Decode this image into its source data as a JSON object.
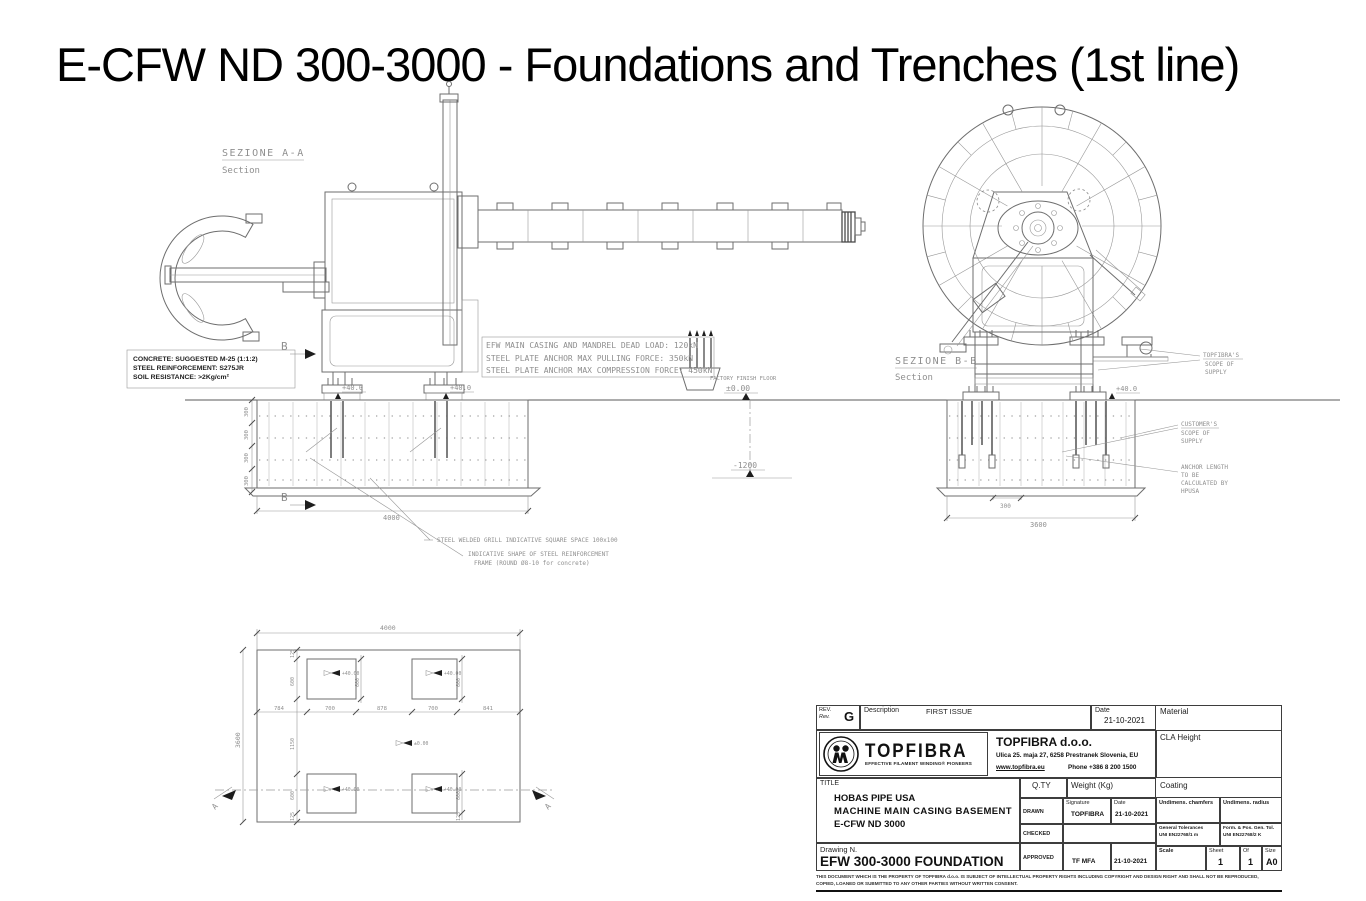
{
  "page": {
    "title": "E-CFW ND 300-3000 - Foundations and Trenches (1st line)"
  },
  "colors": {
    "background": "#ffffff",
    "cad_line": "#6e6e6e",
    "cad_text": "#8f8f8f",
    "ink": "#111111"
  },
  "section_a": {
    "label": "SEZIONE  A-A",
    "sublabel": "Section"
  },
  "section_b": {
    "label": "SEZIONE  B-B",
    "sublabel": "Section"
  },
  "section_markers": {
    "a": "A",
    "b": "B"
  },
  "concrete_note": {
    "line1": "CONCRETE: SUGGESTED M-25 (1:1:2)",
    "line2": "STEEL REINFORCEMENT: S275JR",
    "line3": "SOIL RESISTANCE: >2Kg/cm²"
  },
  "load_note": {
    "line1": "EFW MAIN CASING AND MANDREL DEAD LOAD: 120kN",
    "line2": "STEEL PLATE ANCHOR MAX PULLING FORCE: 350kN",
    "line3": "STEEL PLATE ANCHOR MAX COMPRESSION FORCE: 450kN"
  },
  "floor_note": {
    "label": "FACTORY FINISH FLOOR",
    "level": "±0.00",
    "trench_level": "-1200"
  },
  "grill_note": "STEEL WELDED GRILL INDICATIVE SQUARE SPACE 100x100",
  "frame_note": {
    "line1": "INDICATIVE SHAPE OF STEEL REINFORCEMENT",
    "line2": "FRAME (ROUND Ø8-10 for concrete)"
  },
  "scope_topfibra": {
    "line1": "TOPFIBRA'S",
    "line2": "SCOPE OF",
    "line3": "SUPPLY"
  },
  "scope_customer": {
    "line1": "CUSTOMER'S",
    "line2": "SCOPE OF",
    "line3": "SUPPLY"
  },
  "anchor_note": {
    "line1": "ANCHOR LENGTH",
    "line2": "TO BE",
    "line3": "CALCULATED BY",
    "line4": "HPUSA"
  },
  "dims": {
    "left_pad": "+40.0",
    "right_pad": "+40.0",
    "bb_pad": "+40.0",
    "left_found_width": "4000",
    "left_chain": [
      "300",
      "300",
      "300",
      "300"
    ],
    "bb_pad_space": "300",
    "bb_found_width": "3600"
  },
  "plan": {
    "width": "4000",
    "height": "3600",
    "row": [
      "784",
      "700",
      "878",
      "700",
      "841"
    ],
    "col": [
      "125",
      "600",
      "1150",
      "600",
      "125"
    ],
    "sq": "600",
    "pad_level": "+40.00",
    "floor_level": "±0.00"
  },
  "titleblock": {
    "rev_label": "REV.",
    "rev_label_it": "Rev.",
    "rev_value": "G",
    "description_label": "Description",
    "description_value": "FIRST ISSUE",
    "date_label": "Date",
    "date_value": "21-10-2021",
    "material_label": "Material",
    "logo": {
      "wordmark": "TOPFIBRA",
      "tagline": "EFFECTIVE FILAMENT WINDING® PIONEERS"
    },
    "company": {
      "name": "TOPFIBRA d.o.o.",
      "address": "Ulica 25. maja 27, 6258 Prestranek Slovenia, EU",
      "web": "www.topfibra.eu",
      "phone": "Phone +386 8 200 1500"
    },
    "cla_label": "CLA Height",
    "title_label": "TITLE",
    "title_line1": "HOBAS PIPE USA",
    "title_line2": "MACHINE MAIN CASING BASEMENT",
    "title_line3": "E-CFW ND 3000",
    "qty_label": "Q.TY",
    "weight_label": "Weight (Kg)",
    "coating_label": "Coating",
    "drawn_label": "DRAWN",
    "signature_label": "Signature",
    "date_col_label": "Date",
    "drawn_signature": "TOPFIBRA",
    "drawn_date": "21-10-2021",
    "checked_label": "CHECKED",
    "approved_label": "APPROVED",
    "approved_signature": "TF MFA",
    "approved_date": "21-10-2021",
    "undim_chamfers_label": "Undimens. chamfers",
    "undim_radius_label": "Undimens. radius",
    "gen_tol_line1": "General Tolerances",
    "gen_tol_line2": "UNI EN22768/1  m",
    "form_tol_line1": "Form. & Pos. Gen. Tol.",
    "form_tol_line2": "UNI EN22768/2  K",
    "drawing_n_label": "Drawing N.",
    "drawing_n_value": "EFW 300-3000 FOUNDATION",
    "scale_label": "Scale",
    "sheet_label": "Sheet",
    "of_label": "Of",
    "size_label": "Size",
    "sheet_value": "1",
    "of_value": "1",
    "size_value": "A0",
    "legal_line1": "THIS DOCUMENT WHICH IS THE PROPERTY OF TOPFIBRA d.o.o. IS SUBJECT OF INTELLECTUAL PROPERTY RIGHTS INCLUDING COPYRIGHT AND DESIGN RIGHT AND SHALL NOT BE REPRODUCED,",
    "legal_line2": "COPIED, LOANED OR SUBMITTED TO ANY OTHER PARTIES WITHOUT WRITTEN CONSENT."
  }
}
